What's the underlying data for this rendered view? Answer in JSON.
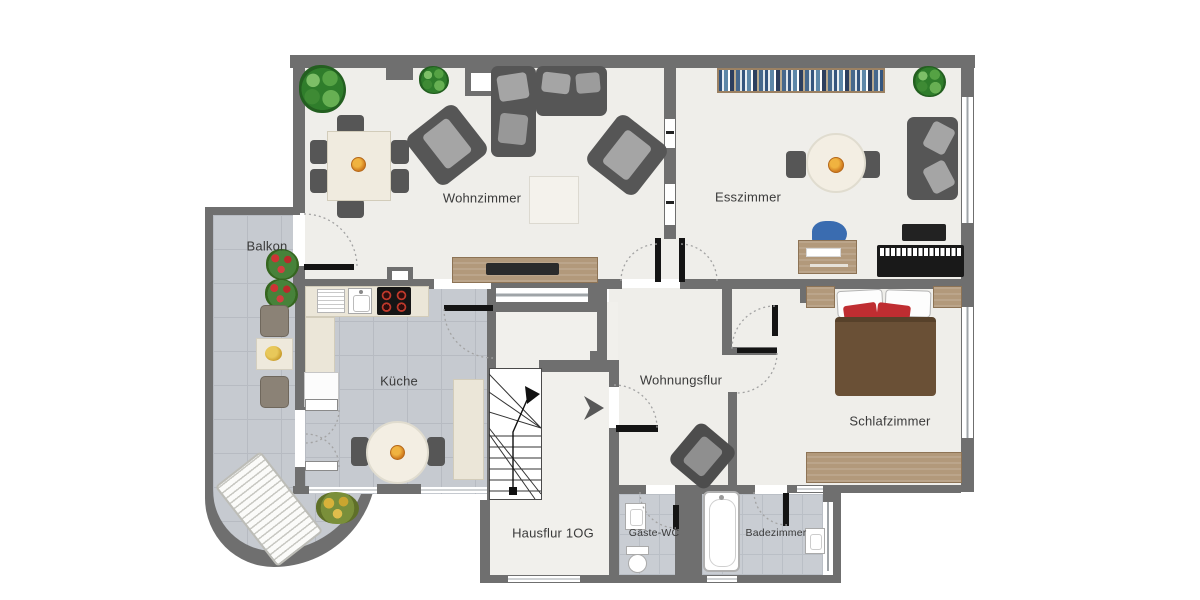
{
  "meta": {
    "type": "floor-plan",
    "floor_label": "1OG"
  },
  "colors": {
    "background": "#ffffff",
    "wall": "#6f6f6f",
    "floor_light": "#efeeea",
    "floor_tiles": "#c6cad0",
    "wood": "#b2997b",
    "upholstery": "#565656",
    "bed_blanket": "#6a5036",
    "red_pillows": "#bf2d31",
    "blue_chair": "#3a6cb0",
    "label_text": "#3a3a3a"
  },
  "rooms": {
    "wohnzimmer": {
      "label": "Wohnzimmer",
      "furniture": [
        "dining-table-with-six-chairs",
        "fruit-bowl",
        "corner-sofa",
        "armchair",
        "armchair",
        "rug",
        "tv-sideboard",
        "potted-plant",
        "potted-plant"
      ]
    },
    "esszimmer": {
      "label": "Esszimmer",
      "furniture": [
        "bookshelf",
        "round-table-with-two-chairs",
        "fruit-bowl",
        "loveseat-sofa",
        "desk",
        "blue-desk-chair",
        "piano",
        "tv-panel",
        "potted-plant"
      ]
    },
    "balkon": {
      "label": "Balkon",
      "furniture": [
        "flower-boxes",
        "bistro-chair",
        "bistro-table",
        "bistro-chair",
        "sun-lounger",
        "potted-plant"
      ]
    },
    "kueche": {
      "label": "Küche",
      "furniture": [
        "counter-with-drainboard",
        "sink",
        "stove",
        "fridge",
        "tall-cabinet",
        "round-table-with-two-chairs",
        "fruit-bowl"
      ]
    },
    "wohnungsflur": {
      "label": "Wohnungsflur",
      "furniture": [
        "armchair"
      ]
    },
    "schlafzimmer": {
      "label": "Schlafzimmer",
      "furniture": [
        "double-bed",
        "nightstand",
        "nightstand",
        "red-pillows",
        "sideboard"
      ]
    },
    "hausflur": {
      "label": "Hausflur 1OG",
      "furniture": [
        "staircase-with-up-arrow",
        "entrance-direction-arrow"
      ]
    },
    "gaeste_wc": {
      "label": "Gäste-WC",
      "furniture": [
        "wash-basin",
        "toilet"
      ]
    },
    "badezimmer": {
      "label": "Badezimmer",
      "furniture": [
        "bathtub",
        "wash-basin"
      ]
    }
  },
  "fixtures": {
    "windows": 10,
    "door_swing_arcs": 9,
    "double_door_leaves": 2,
    "glass_partition_panes": 2
  }
}
